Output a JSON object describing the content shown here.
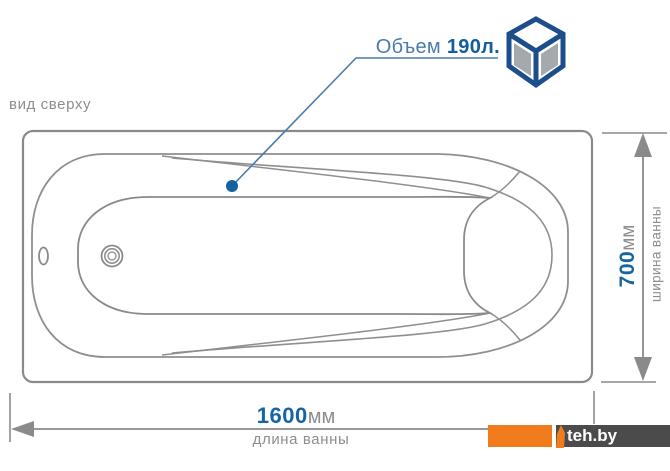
{
  "diagram": {
    "view_label": "вид сверху",
    "volume": {
      "label": "Объем",
      "value": "190л."
    },
    "length": {
      "value": "1600",
      "unit": "мм",
      "caption": "длина ванны"
    },
    "width": {
      "value": "700",
      "unit": "мм",
      "caption": "ширина ванны"
    },
    "watermark": "teh.by",
    "colors": {
      "line_gray": "#8a8a8a",
      "text_gray": "#8d8d8d",
      "dimension_value_blue": "#1565a3",
      "volume_label_blue": "#4a7cab",
      "volume_value_blue": "#135d9c",
      "leader_blue": "#4a7cab",
      "cube_icon_blue": "#1c4e8c",
      "cube_icon_gray": "#a5a9ad",
      "watermark_orange": "#f07c1e",
      "watermark_dark": "#4b4b4b"
    },
    "icons": {
      "cube": "volume-cube-icon"
    }
  }
}
